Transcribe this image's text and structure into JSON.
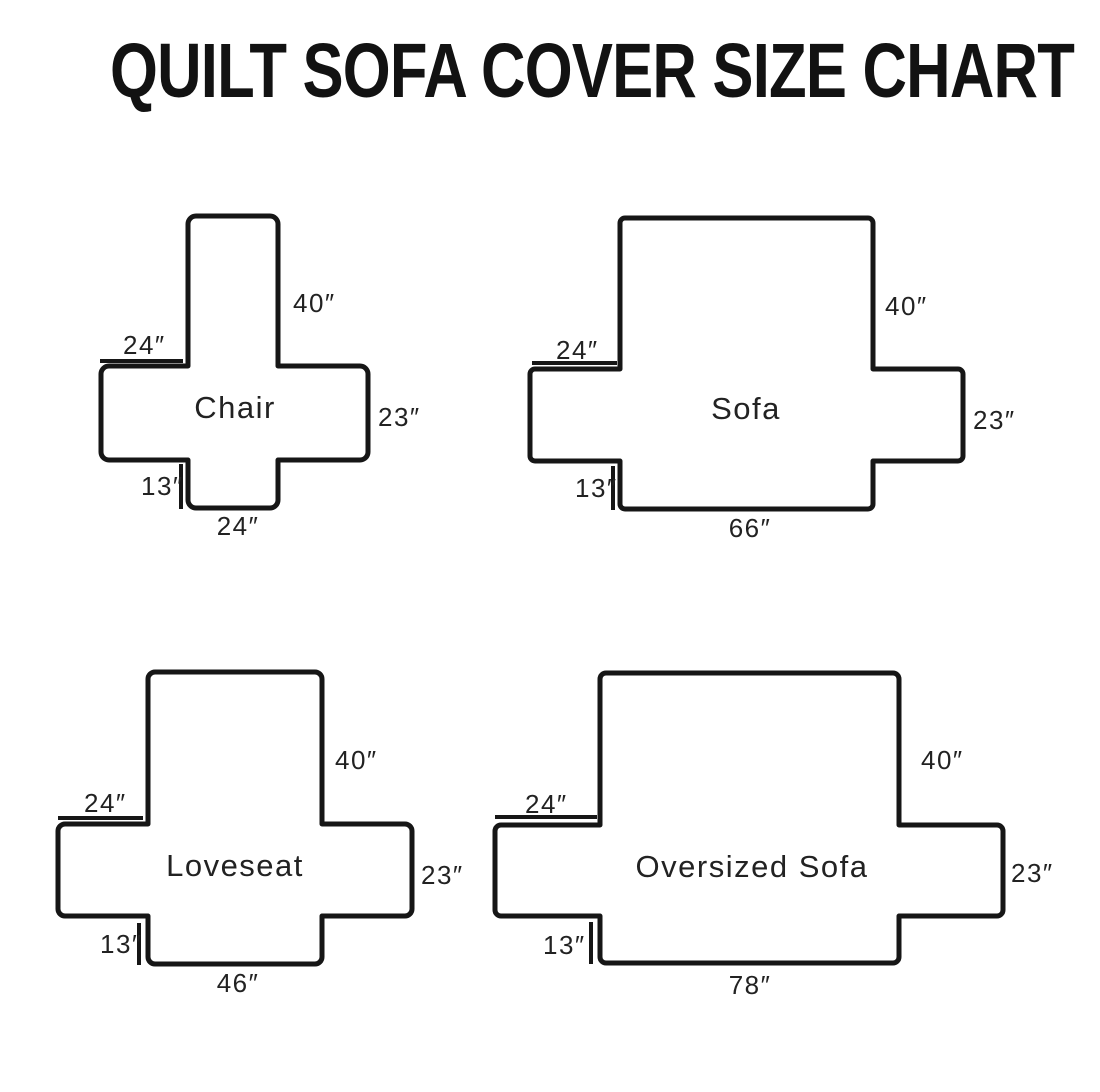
{
  "title": "QUILT SOFA COVER SIZE CHART",
  "diagrams": [
    {
      "id": "chair",
      "name": "Chair",
      "dims": {
        "back": "40″",
        "arm_top": "24″",
        "side": "23″",
        "front": "13″",
        "bottom": "24″"
      }
    },
    {
      "id": "sofa",
      "name": "Sofa",
      "dims": {
        "back": "40″",
        "arm_top": "24″",
        "side": "23″",
        "front": "13″",
        "bottom": "66″"
      }
    },
    {
      "id": "loveseat",
      "name": "Loveseat",
      "dims": {
        "back": "40″",
        "arm_top": "24″",
        "side": "23″",
        "front": "13″",
        "bottom": "46″"
      }
    },
    {
      "id": "oversized-sofa",
      "name": "Oversized Sofa",
      "dims": {
        "back": "40″",
        "arm_top": "24″",
        "side": "23″",
        "front": "13″",
        "bottom": "78″"
      }
    }
  ]
}
